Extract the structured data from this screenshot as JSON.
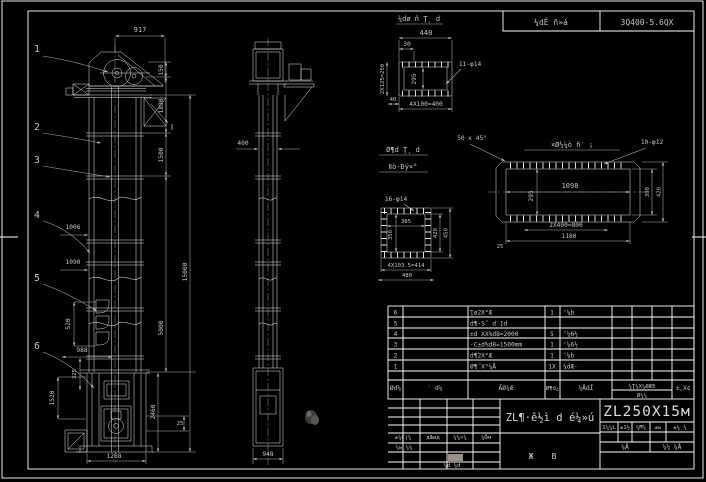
{
  "colors": {
    "bg": "#000000",
    "line": "#ffffff",
    "dim_text": "#c6c6c6"
  },
  "header_strip": {
    "left": "¼dÊ ñ»á",
    "right": "3Q400-5.6QX"
  },
  "balloons": {
    "n1": "1",
    "n2": "2",
    "n3": "3",
    "n4": "4",
    "n5": "5",
    "n6": "6"
  },
  "front_view": {
    "d917": "917",
    "d150": "150",
    "d1890": "1890",
    "d1500": "1500",
    "d5000": "5000",
    "d15000": "15000",
    "d1006": "1006",
    "d1090": "1090",
    "d520": "520",
    "d988": "988",
    "d325": "325",
    "d1520": "1520",
    "d2460": "2460",
    "d25": "25",
    "d1268": "1268",
    "section_mark": "Ⅰ"
  },
  "side_view": {
    "d400": "400",
    "d948": "948"
  },
  "detail_top": {
    "title": "¼dø ñ Ţ¸ d",
    "d440": "440",
    "d30": "30",
    "d40": "40",
    "d250": "2X125=250",
    "d295": "295",
    "holes": "11-φ14",
    "d400": "4X100=400"
  },
  "detail_right": {
    "title": "¤Ø½¼ò ñ′ ¡",
    "chamfer": "50 x 45°",
    "holes": "10-φ12",
    "d1098": "1098",
    "d295": "295",
    "d800": "2X400=800",
    "d1180": "1180",
    "d25": "25",
    "d390": "390",
    "d420": "420"
  },
  "detail_small": {
    "holes": "16-φ14",
    "d385": "385",
    "d350": "350",
    "d420": "420",
    "d450": "450",
    "d414": "4X103.5=414",
    "d480": "480"
  },
  "notes": {
    "line1": "Ø¶d Ţ¸ d",
    "line2": "Ⅱò-Đý×°"
  },
  "bom": {
    "rows": [
      {
        "no": "6",
        "name": "Ţø2X°Æ",
        "qty": "1",
        "mat": "ʻ¼b"
      },
      {
        "no": "5",
        "name": "d¶·S˝ d′1d",
        "qty": "",
        "mat": ""
      },
      {
        "no": "4",
        "name": "±d XX%d8=2000",
        "qty": "5",
        "mat": "ʻ¼6½"
      },
      {
        "no": "3",
        "name": "·C±d%d8=1500mm",
        "qty": "1",
        "mat": "ʻ¼6½"
      },
      {
        "no": "2",
        "name": "d¶2X°Æ",
        "qty": "1",
        "mat": "ʻ¼b"
      },
      {
        "no": "1",
        "name": "Ø¶˝X°¼Å",
        "qty": "1X",
        "mat": "¼dÆ·"
      }
    ],
    "header": {
      "no": "Ød¼",
      "dwg": "′ d¼",
      "name": "ÃØ¼Æ",
      "qty": "Ø¶d¿",
      "mat": "¼ÅdĪ",
      "w1": "¼Ţ¼X¼ØÆE",
      "w2": "Ø¼¼",
      "remark": "±,X¢"
    }
  },
  "title_block": {
    "model": "ZL250X15м",
    "title": "ZL¶·ê½ì d é¼»ú",
    "sheet_l": "Ж",
    "sheet_r": "В",
    "row1": {
      "c1": "±¼Ć|¼",
      "c2": "дЉид",
      "c3": "¼¼×¼",
      "c4": "¼Ōм"
    },
    "row2": "¼ь ¼¼",
    "row3": "¼d ¼d",
    "right_row": {
      "c1": "1¼¼L",
      "c2": "±1½",
      "c3": "¼Ħ¼",
      "c4": "±ь",
      "c5": "±¼ ¼"
    },
    "mid_row": {
      "c1": "¼Å",
      "c2": "¼¼ ¼Å"
    }
  }
}
